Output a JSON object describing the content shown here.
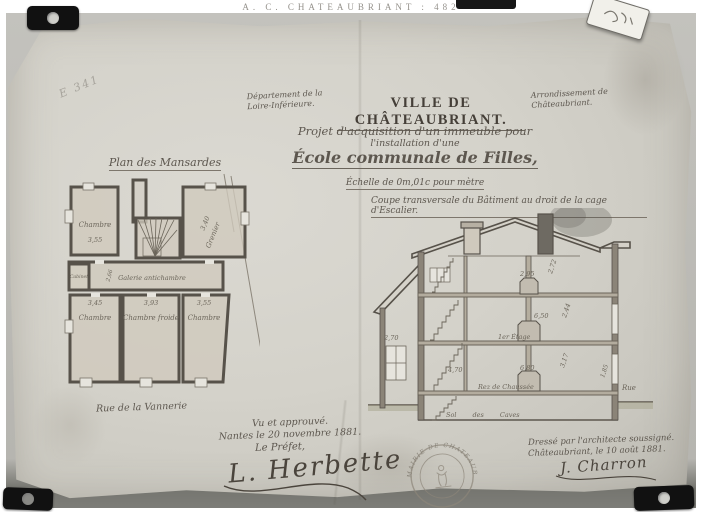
{
  "archive": {
    "header": "A. C. CHATEAUBRIANT : 482",
    "pencil_note": "E 341"
  },
  "title_block": {
    "department": "Département de la Loire-Inférieure.",
    "city": "VILLE DE CHÂTEAUBRIANT.",
    "arrondissement": "Arrondissement de Châteaubriant.",
    "project_line1": "Projet d'acquisition d'un immeuble pour",
    "project_line2": "l'installation d'une",
    "school_title": "École communale de Filles,",
    "scale_note": "Échelle de 0m,01c pour mètre"
  },
  "plan": {
    "title": "Plan des Mansardes",
    "street_label": "Rue de la Vannerie",
    "rooms": [
      {
        "label": "Chambre",
        "dim": "3,55"
      },
      {
        "label": "Grenier",
        "dim": "3,40"
      },
      {
        "label": "Galerie antichambre",
        "dim": "2,66"
      },
      {
        "label": "Cabinet",
        "dim": ""
      },
      {
        "label": "Chambre",
        "dim": "3,45"
      },
      {
        "label": "Chambre froide",
        "dim": "3,93"
      },
      {
        "label": "Chambre",
        "dim": "3,55"
      }
    ]
  },
  "section": {
    "title": "Coupe transversale du Bâtiment au droit de la cage d'Escalier.",
    "floors": [
      "1er Étage",
      "Rez de Chaussée",
      "Sol des Caves"
    ],
    "street_label": "Rue",
    "dims": {
      "attic_height": "2,95",
      "attic_right": "2,72",
      "first_width": "6,50",
      "first_right": "2,44",
      "ground_width": "6,80",
      "stair_width": "4,70",
      "annex": "2,70",
      "ground_right": "3,17",
      "wall_right": "1,85"
    }
  },
  "approval": {
    "line1": "Vu et approuvé.",
    "line2": "Nantes le 20 novembre 1881.",
    "line3": "Le Préfet,",
    "signature": "L. Herbette"
  },
  "attribution": {
    "line1": "Dressé par l'architecte soussigné.",
    "line2": "Châteaubriant, le 10 août 1881.",
    "signature": "J. Charron"
  },
  "stamp": {
    "text": "MAIRIE DE CHATEAUBRIANT"
  }
}
